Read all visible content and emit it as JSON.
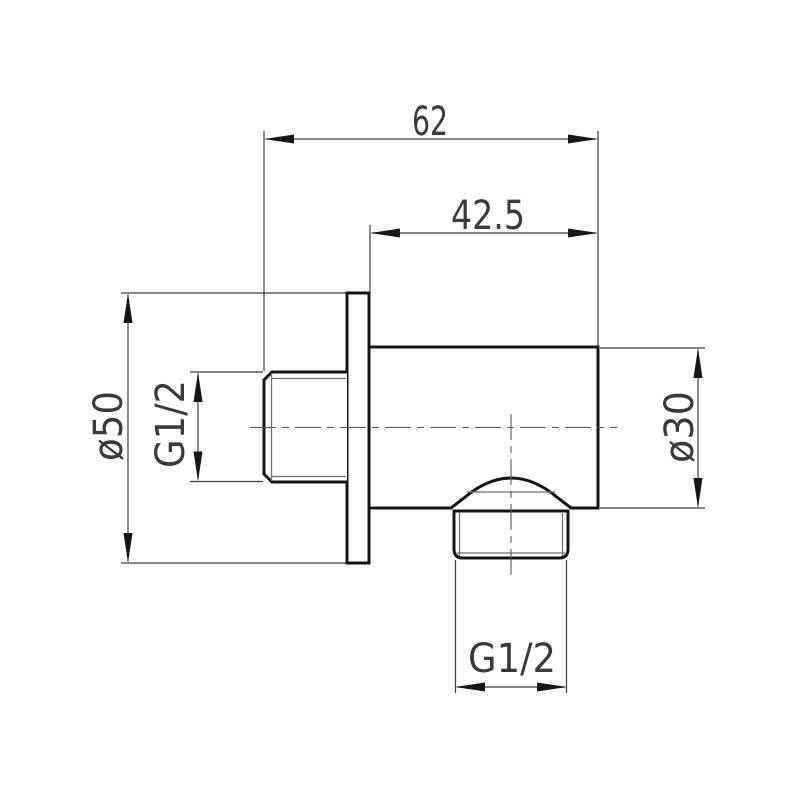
{
  "meta": {
    "description": "Technical dimension drawing of a wall-mounted round shower outlet elbow",
    "background_color": "#ffffff",
    "outline_color": "#141414",
    "dimension_color": "#3a3a3a"
  },
  "dims": {
    "overall_width": "62",
    "body_length": "42.5",
    "flange_diameter": "ø50",
    "inlet_thread": "G1/2",
    "body_diameter": "ø30",
    "outlet_thread": "G1/2"
  }
}
